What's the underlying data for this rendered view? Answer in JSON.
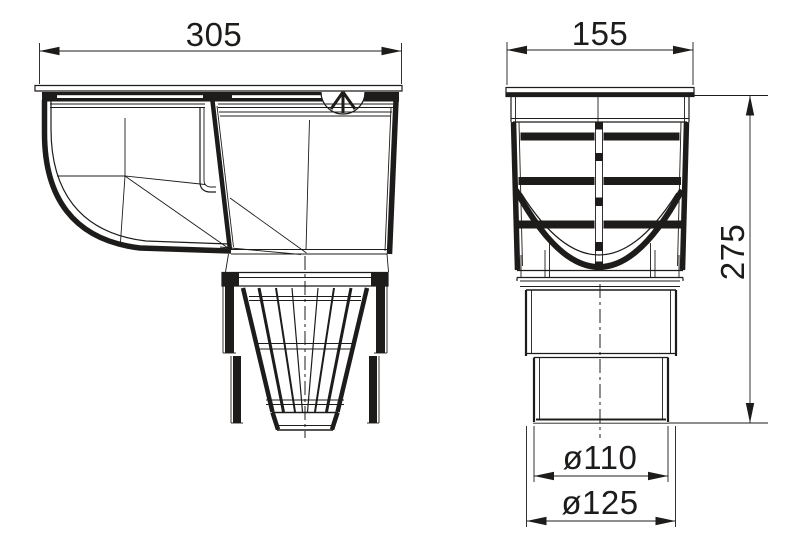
{
  "drawing": {
    "background_color": "#ffffff",
    "line_color": "#1e1c1a",
    "dimensions": {
      "side_width": "305",
      "front_width": "155",
      "overall_height": "275",
      "outlet_diameter": "ø110",
      "socket_diameter": "ø125"
    }
  }
}
